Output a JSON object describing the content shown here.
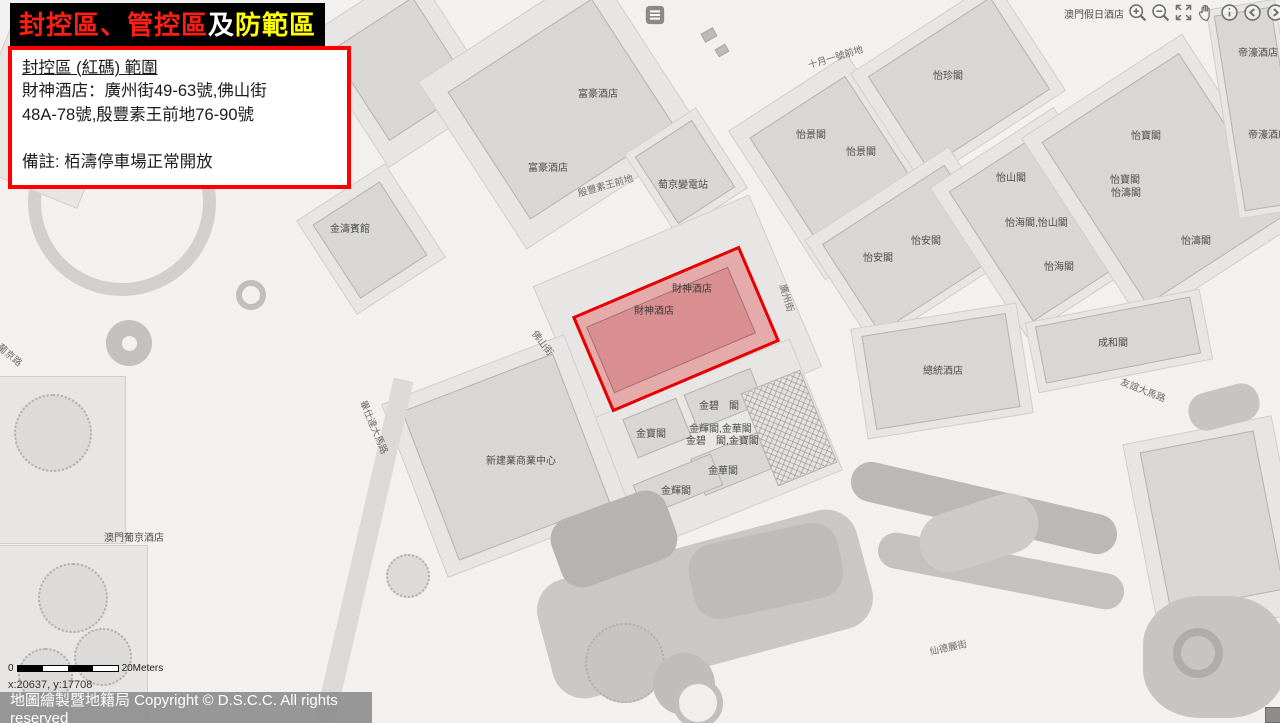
{
  "banner": {
    "segment_red": "封控區、管控區",
    "segment_white": "及",
    "segment_yellow": "防範區"
  },
  "info_box": {
    "heading": "封控區 (紅碼) 範圍",
    "line1": "財神酒店：廣州街49-63號,佛山街",
    "line2": "48A-78號,殷豐素王前地76-90號",
    "note": "備註: 栢濤停車場正常開放"
  },
  "toolbar": {
    "icons": [
      "zoom-in",
      "zoom-out",
      "full-extent",
      "pan",
      "identify",
      "previous-extent",
      "next-extent"
    ]
  },
  "map": {
    "labels": [
      "澳門假日酒店",
      "帝濠酒店",
      "帝濠酒店",
      "十月一號前地",
      "怡珍閣",
      "富豪酒店",
      "富豪酒店",
      "殷豐素王前地",
      "萄京變電站",
      "怡景閣",
      "怡景閣",
      "怡山閣",
      "怡寶閣",
      "怡寶閣",
      "怡濤閣",
      "怡海閣,怡山閣",
      "怡安閣",
      "怡安閣",
      "怡海閣",
      "怡濤閣",
      "金濤賓館",
      "財神酒店",
      "財神酒店",
      "廣州街",
      "佛山街",
      "成和閣",
      "總統酒店",
      "友誼大馬路",
      "金碧　閣",
      "金寶閣",
      "金輝閣,金華閣",
      "金碧　閣,金寶閣",
      "金華閣",
      "金輝閣",
      "新建業商業中心",
      "畢仕達大馬路",
      "澳門葡京酒店",
      "葡京路",
      "仙德麗街"
    ]
  },
  "scale_bar": {
    "start": "0",
    "end": "20Meters"
  },
  "status": {
    "coordinates": "x:20637, y:17708"
  },
  "footer": {
    "copyright": "地圖繪製暨地籍局 Copyright © D.S.C.C. All rights reserved"
  },
  "colors": {
    "zone_border": "#e60000",
    "zone_fill": "rgba(226,88,88,0.42)",
    "banner_red": "#ff1e14",
    "banner_yellow": "#ffff00"
  }
}
